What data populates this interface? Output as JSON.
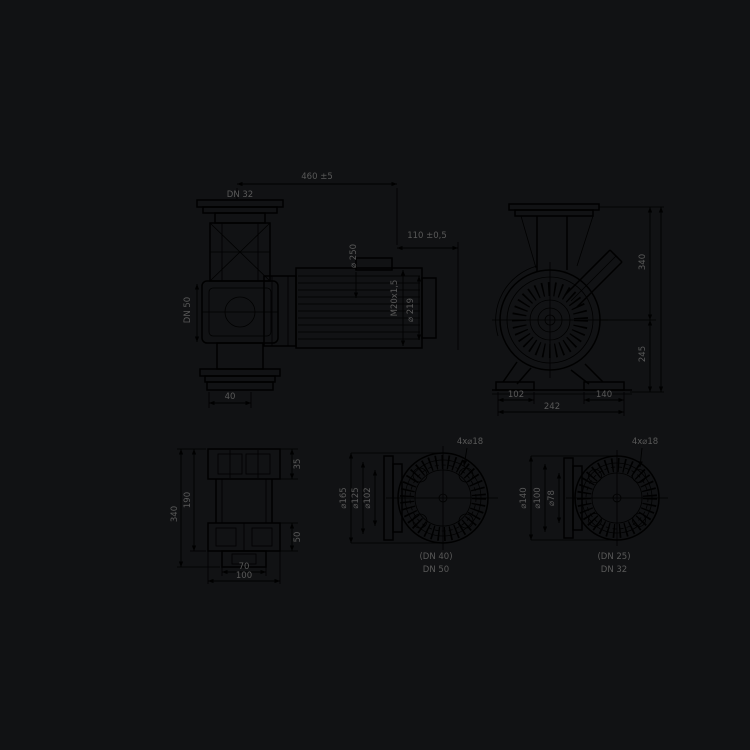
{
  "title": "Pump dimensional drawing",
  "colors": {
    "background": "#111214",
    "line": "#000000",
    "text": "#595959"
  },
  "side_view": {
    "flange_top_label": "DN 32",
    "overall_length": "460 ±5",
    "shaft_dim": "110 ±0,5",
    "casing_dia": "⌀ 250",
    "gland_label": "M20x1,5",
    "motor_dia": "⌀ 219",
    "suction_label": "DN 50",
    "foot_dim": "40"
  },
  "front_view": {
    "height_upper": "340",
    "height_lower": "245",
    "foot_left": "102",
    "foot_right": "140",
    "foot_total": "242"
  },
  "plan_view": {
    "length_outer": "340",
    "length_inner": "190",
    "slot_top": "35",
    "slot_bottom": "50",
    "width_inner": "70",
    "width_outer": "100"
  },
  "flange_a": {
    "holes": "4x⌀18",
    "dia_outer": "⌀165",
    "dia_bolt": "⌀125",
    "dia_face": "⌀102",
    "label_alt": "(DN 40)",
    "label": "DN 50"
  },
  "flange_b": {
    "holes": "4x⌀18",
    "dia_outer": "⌀140",
    "dia_bolt": "⌀100",
    "dia_face": "⌀78",
    "label_alt": "(DN 25)",
    "label": "DN 32"
  }
}
